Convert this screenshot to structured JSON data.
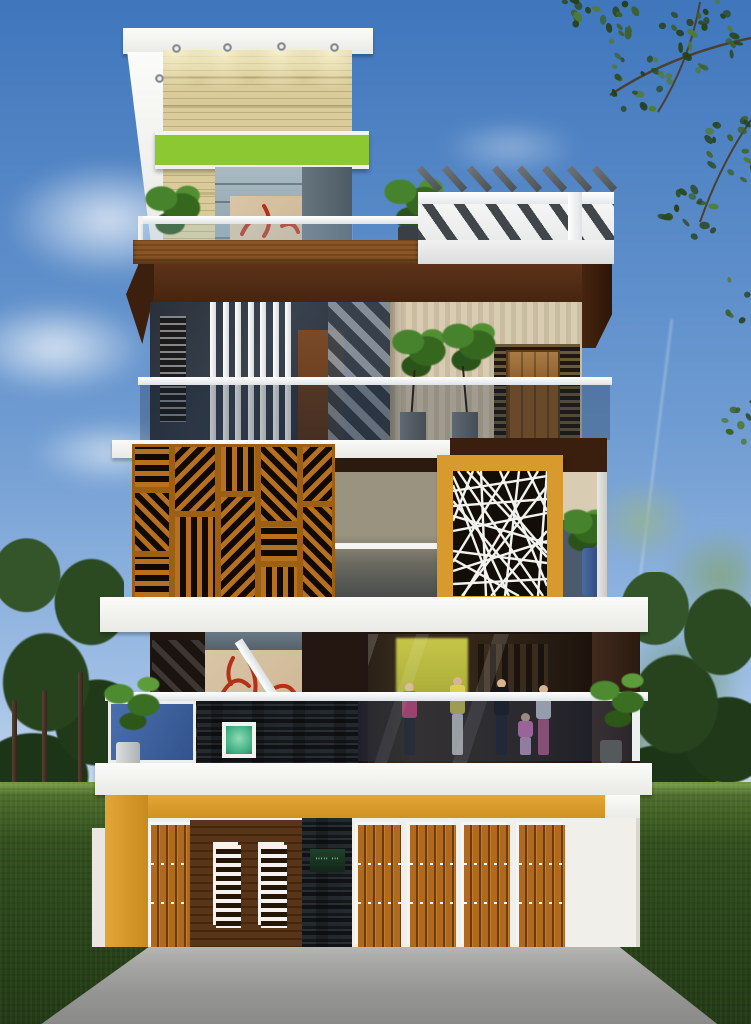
{
  "scene": {
    "type": "architectural-elevation-render",
    "description": "3D front-elevation render of a modern four-level house with rooftop pergolas, wooden jali screens, a CNC-cut white jali panel in a mustard frame, a ground-floor boutique display with mannequins, wooden slat gates, lawn, trees and a concrete driveway",
    "visible_text": "none (only an illegible dotted house nameplate)"
  },
  "palette": {
    "skyTop": "#3f76bc",
    "cloud": "#ffffff",
    "treeDark": "#26431e",
    "treeHaze": "#8fae8a",
    "grass": "#32501d",
    "grassLight": "#7ea250",
    "road": "#9a9a98",
    "white": "#f4f4f2",
    "stoneBeige": "#ddd1a0",
    "canopyGreen": "#8cc832",
    "deckWood": "#8a5526",
    "fasciaBrown": "#46250f",
    "tanWall": "#d8ccb2",
    "doorWood": "#8a5a28",
    "glassDark": "#2e3844",
    "glassBlue": "#43608c",
    "latticeWood": "#b5711f",
    "mustard": "#d89a2c",
    "slate": "#393d40",
    "plankBrown": "#57341a",
    "gateWood": "#b06a1f",
    "plateGreen": "#16351f",
    "artBeige": "#d9c6a6",
    "artRed": "#b53018",
    "shopYellow": "#c3c23f",
    "potBlue": "#3a5c90"
  },
  "terrace": {
    "downlights_x": [
      172,
      223,
      277,
      330,
      155
    ],
    "downlights_y": [
      44,
      43,
      42,
      43,
      74
    ],
    "pergola_fin_count": 8,
    "plant_count": 2
  },
  "floor3": {
    "louver_count": 7,
    "louver_start_x": 210,
    "louver_step": 12.5,
    "plant_count": 2
  },
  "floor2": {
    "lattice_tiles": [
      {
        "x": 0,
        "y": 0,
        "w": 40,
        "h": 46,
        "a": 0
      },
      {
        "x": 0,
        "y": 46,
        "w": 40,
        "h": 64,
        "a": 45
      },
      {
        "x": 0,
        "y": 110,
        "w": 40,
        "h": 46,
        "a": 0
      },
      {
        "x": 40,
        "y": 0,
        "w": 46,
        "h": 70,
        "a": 135
      },
      {
        "x": 40,
        "y": 70,
        "w": 46,
        "h": 86,
        "a": 90
      },
      {
        "x": 86,
        "y": 0,
        "w": 40,
        "h": 50,
        "a": 90
      },
      {
        "x": 86,
        "y": 50,
        "w": 40,
        "h": 106,
        "a": 135
      },
      {
        "x": 126,
        "y": 0,
        "w": 42,
        "h": 80,
        "a": 45
      },
      {
        "x": 126,
        "y": 80,
        "w": 42,
        "h": 40,
        "a": 0
      },
      {
        "x": 126,
        "y": 120,
        "w": 42,
        "h": 36,
        "a": 90
      },
      {
        "x": 168,
        "y": 0,
        "w": 35,
        "h": 60,
        "a": 135
      },
      {
        "x": 168,
        "y": 60,
        "w": 35,
        "h": 96,
        "a": 45
      }
    ],
    "cnc_lines": [
      [
        0,
        20,
        94,
        5
      ],
      [
        0,
        35,
        94,
        28
      ],
      [
        5,
        0,
        90,
        125
      ],
      [
        0,
        60,
        94,
        42
      ],
      [
        10,
        125,
        85,
        0
      ],
      [
        0,
        80,
        94,
        92
      ],
      [
        0,
        100,
        94,
        70
      ],
      [
        20,
        0,
        0,
        50
      ],
      [
        75,
        0,
        94,
        40
      ],
      [
        0,
        5,
        56,
        125
      ],
      [
        38,
        125,
        94,
        60
      ],
      [
        0,
        113,
        94,
        108
      ],
      [
        28,
        0,
        33,
        125
      ],
      [
        66,
        0,
        52,
        125
      ],
      [
        0,
        45,
        94,
        72
      ],
      [
        14,
        0,
        94,
        86
      ],
      [
        80,
        125,
        0,
        30
      ],
      [
        47,
        0,
        94,
        115
      ],
      [
        0,
        88,
        66,
        125
      ],
      [
        94,
        15,
        9,
        125
      ],
      [
        56,
        0,
        0,
        91
      ],
      [
        94,
        82,
        24,
        0
      ],
      [
        42,
        125,
        0,
        14
      ],
      [
        85,
        125,
        94,
        0
      ]
    ]
  },
  "floor1": {
    "art_strokes": [
      "M14,50 q14,-30 30,-14",
      "M44,12 q12,22 2,44",
      "M66,40 q16,-10 24,4",
      "M28,8 q-8,14 -2,26"
    ],
    "terrace_art_strokes": [
      "M12,38 q10,-22 26,-12",
      "M34,10 q10,16 0,30",
      "M52,30 q12,-6 16,6"
    ],
    "mannequins": [
      {
        "left": 34,
        "h": 74,
        "top": "#d8487a",
        "legs": "#2a2624"
      },
      {
        "left": 82,
        "h": 80,
        "top": "#ddd04e",
        "legs": "#d8d4c8"
      },
      {
        "left": 126,
        "h": 78,
        "top": "#17151a",
        "legs": "#201e22"
      },
      {
        "left": 168,
        "h": 72,
        "top": "#cfd2d6",
        "legs": "#b85a80"
      },
      {
        "left": 150,
        "h": 44,
        "top": "#d878b8",
        "legs": "#c9a0c2"
      }
    ]
  },
  "ground": {
    "gate_panels": [
      {
        "x": 148,
        "w": 42
      },
      {
        "x": 355,
        "w": 43
      },
      {
        "x": 407,
        "w": 46
      },
      {
        "x": 461,
        "w": 46
      },
      {
        "x": 516,
        "w": 46
      }
    ],
    "louver_windows": [
      {
        "x": 213,
        "w": 25
      },
      {
        "x": 258,
        "w": 26
      }
    ],
    "plate_text": "''''' '''"
  },
  "environment": {
    "canopy_clusters": [
      {
        "cx": 160,
        "cy": 30,
        "r": 46,
        "n": 30
      },
      {
        "cx": 100,
        "cy": 82,
        "r": 36,
        "n": 20
      },
      {
        "cx": 196,
        "cy": 150,
        "r": 40,
        "n": 22
      },
      {
        "cx": 150,
        "cy": 212,
        "r": 30,
        "n": 15
      },
      {
        "cx": 205,
        "cy": 300,
        "r": 28,
        "n": 12
      },
      {
        "cx": 78,
        "cy": 20,
        "r": 26,
        "n": 13
      },
      {
        "cx": 40,
        "cy": 8,
        "r": 18,
        "n": 8
      },
      {
        "cx": 206,
        "cy": 420,
        "r": 26,
        "n": 10
      }
    ]
  }
}
